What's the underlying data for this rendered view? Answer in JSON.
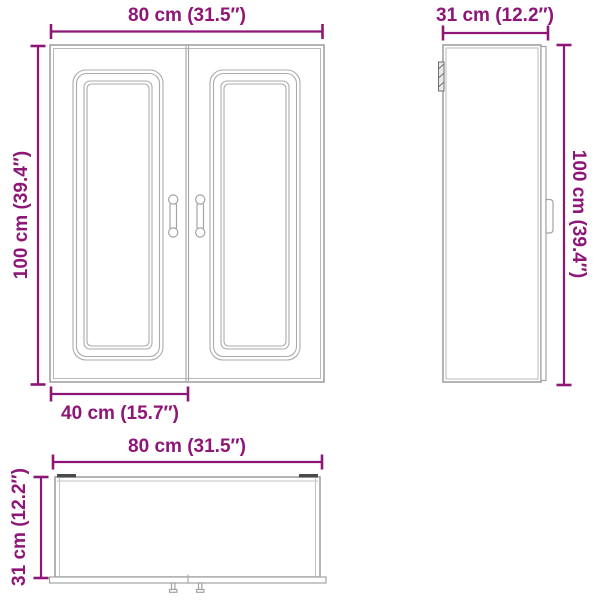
{
  "drawing": {
    "subject": "wall-cabinet-two-doors-dimension-diagram",
    "background_color": "#ffffff",
    "dimension_color": "#8D1677",
    "outline_color": "#9C9C9C",
    "views": {
      "front": {
        "name": "front-view",
        "width_label": "80 cm (31.5″)",
        "height_label": "100 cm (39.4″)",
        "door_width_label": "40 cm (15.7″)"
      },
      "side": {
        "name": "side-view",
        "depth_label": "31 cm (12.2″)",
        "height_label": "100 cm (39.4″)"
      },
      "bottom": {
        "name": "bottom-view",
        "width_label": "80 cm (31.5″)",
        "depth_label": "31 cm (12.2″)"
      }
    }
  }
}
